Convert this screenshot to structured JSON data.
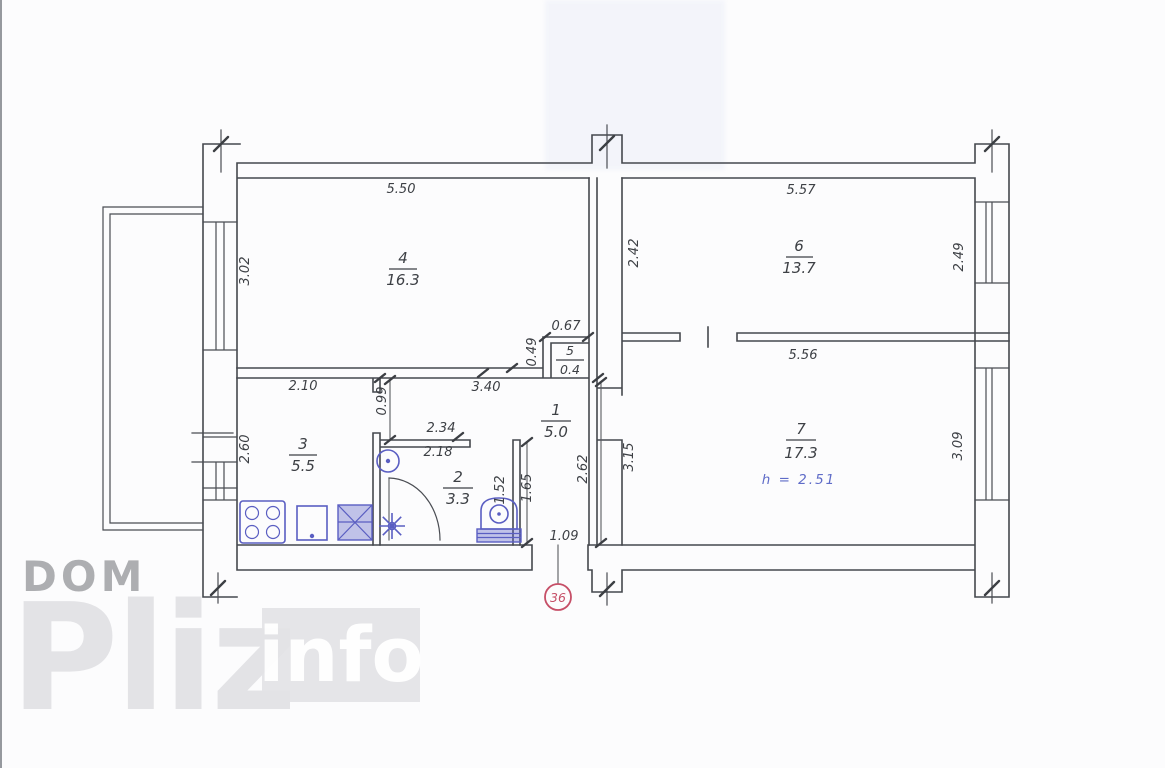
{
  "watermark": {
    "dom": "DOM",
    "pliz": "Pliz",
    "info": "info"
  },
  "plan": {
    "rooms": [
      {
        "number": "1",
        "area": "5.0"
      },
      {
        "number": "2",
        "area": "3.3"
      },
      {
        "number": "3",
        "area": "5.5"
      },
      {
        "number": "4",
        "area": "16.3"
      },
      {
        "number": "5",
        "area": "0.4"
      },
      {
        "number": "6",
        "area": "13.7"
      },
      {
        "number": "7",
        "area": "17.3",
        "height_note": "h = 2.51"
      }
    ],
    "dimensions": {
      "room4_width": "5.50",
      "room4_depth": "3.02",
      "room6_width": "5.57",
      "room6_left": "2.42",
      "room6_right": "2.49",
      "room5_width": "0.67",
      "room5_depth": "0.49",
      "room7_width": "5.56",
      "room7_left": "3.15",
      "room7_right": "3.09",
      "room3_width": "2.10",
      "room3_depth": "2.60",
      "hall_width": "3.40",
      "hall_wall_seg": "0.99",
      "hall_depth": "2.62",
      "bath_outer_width": "2.34",
      "bath_inner_width": "2.18",
      "bath_inner_depth": "1.52",
      "bath_outer_depth": "1.65",
      "entry_width": "1.09"
    },
    "entrance_marker": "36",
    "colors": {
      "wall_line": "#45484e",
      "fixture_blue": "#5a5ec2",
      "height_note_blue": "#5f6cc8",
      "entrance_marker_red": "#c64f67",
      "watermark_gray": "#adaeb1"
    }
  }
}
